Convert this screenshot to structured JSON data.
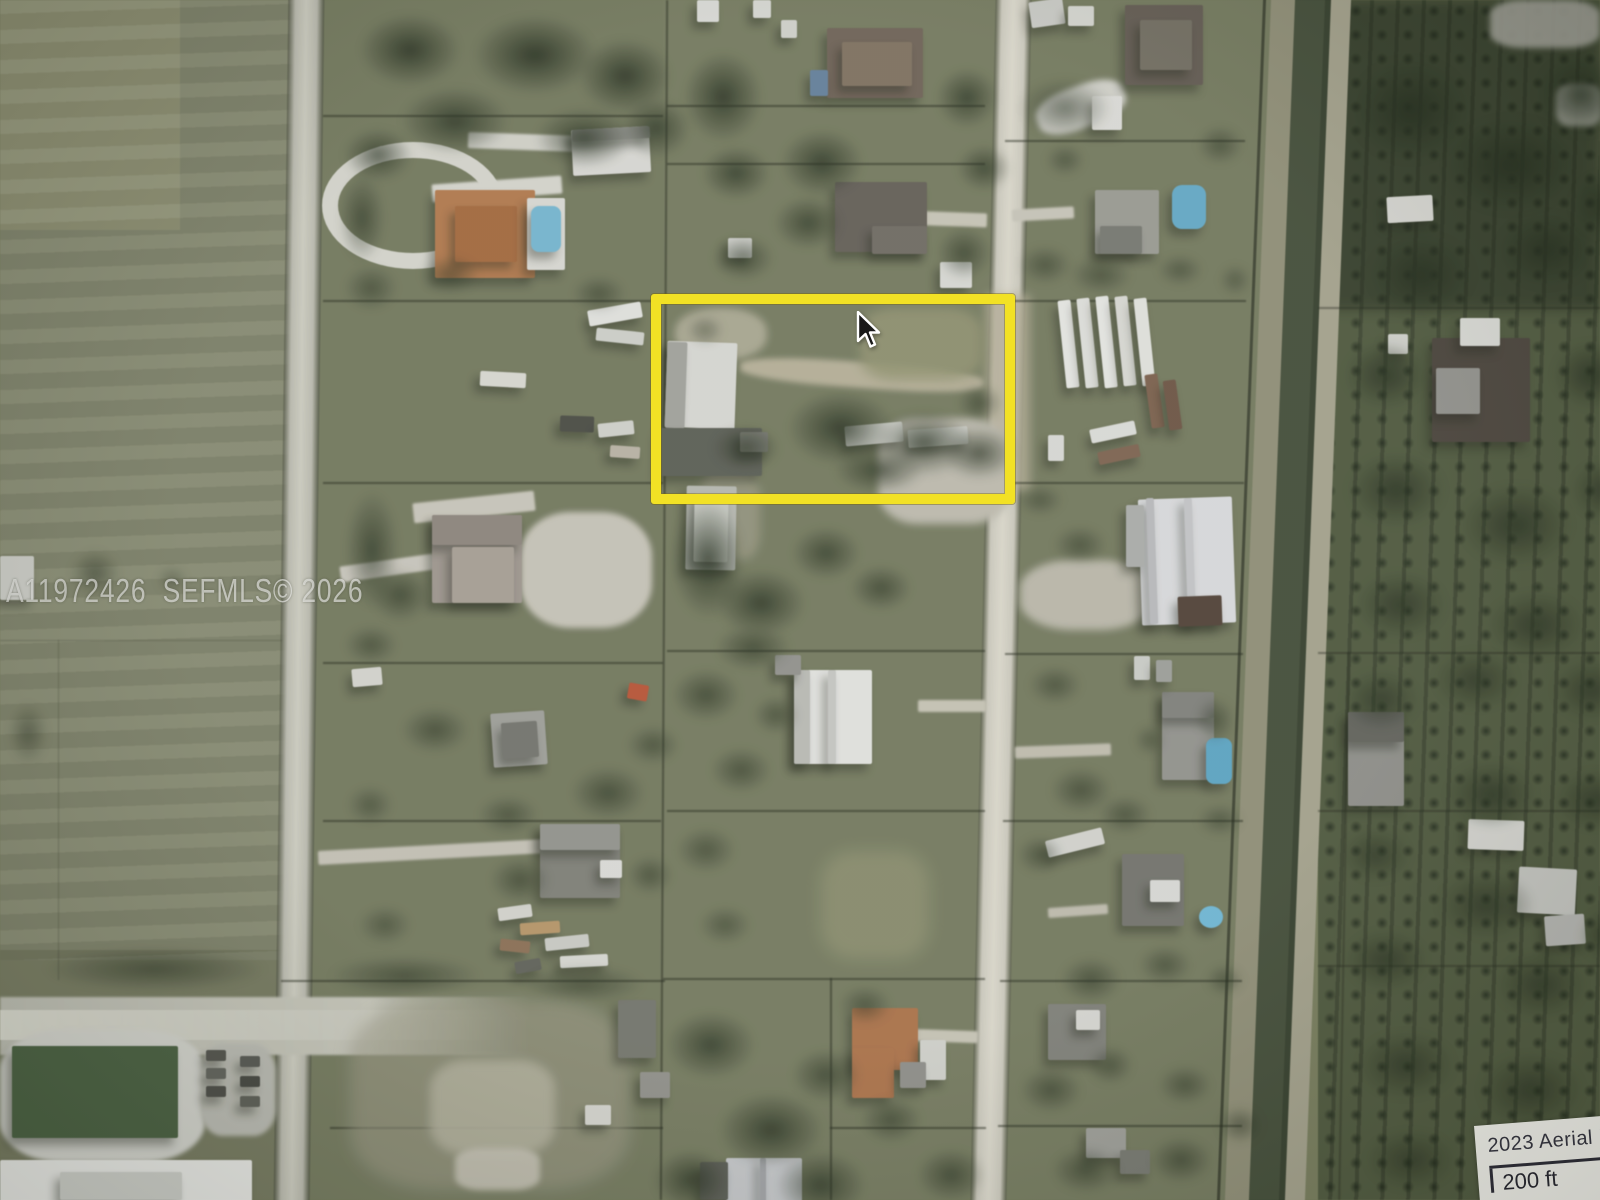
{
  "overlay": {
    "watermark": "A11972426  SEFMLS© 2026",
    "scale_box": {
      "caption": "2023 Aerial Ph",
      "scale_label": "200 ft"
    }
  },
  "highlight": {
    "color": "#f2e01c",
    "x": 651,
    "y": 294,
    "width": 344,
    "height": 190
  },
  "cursor": {
    "x": 856,
    "y": 311
  }
}
